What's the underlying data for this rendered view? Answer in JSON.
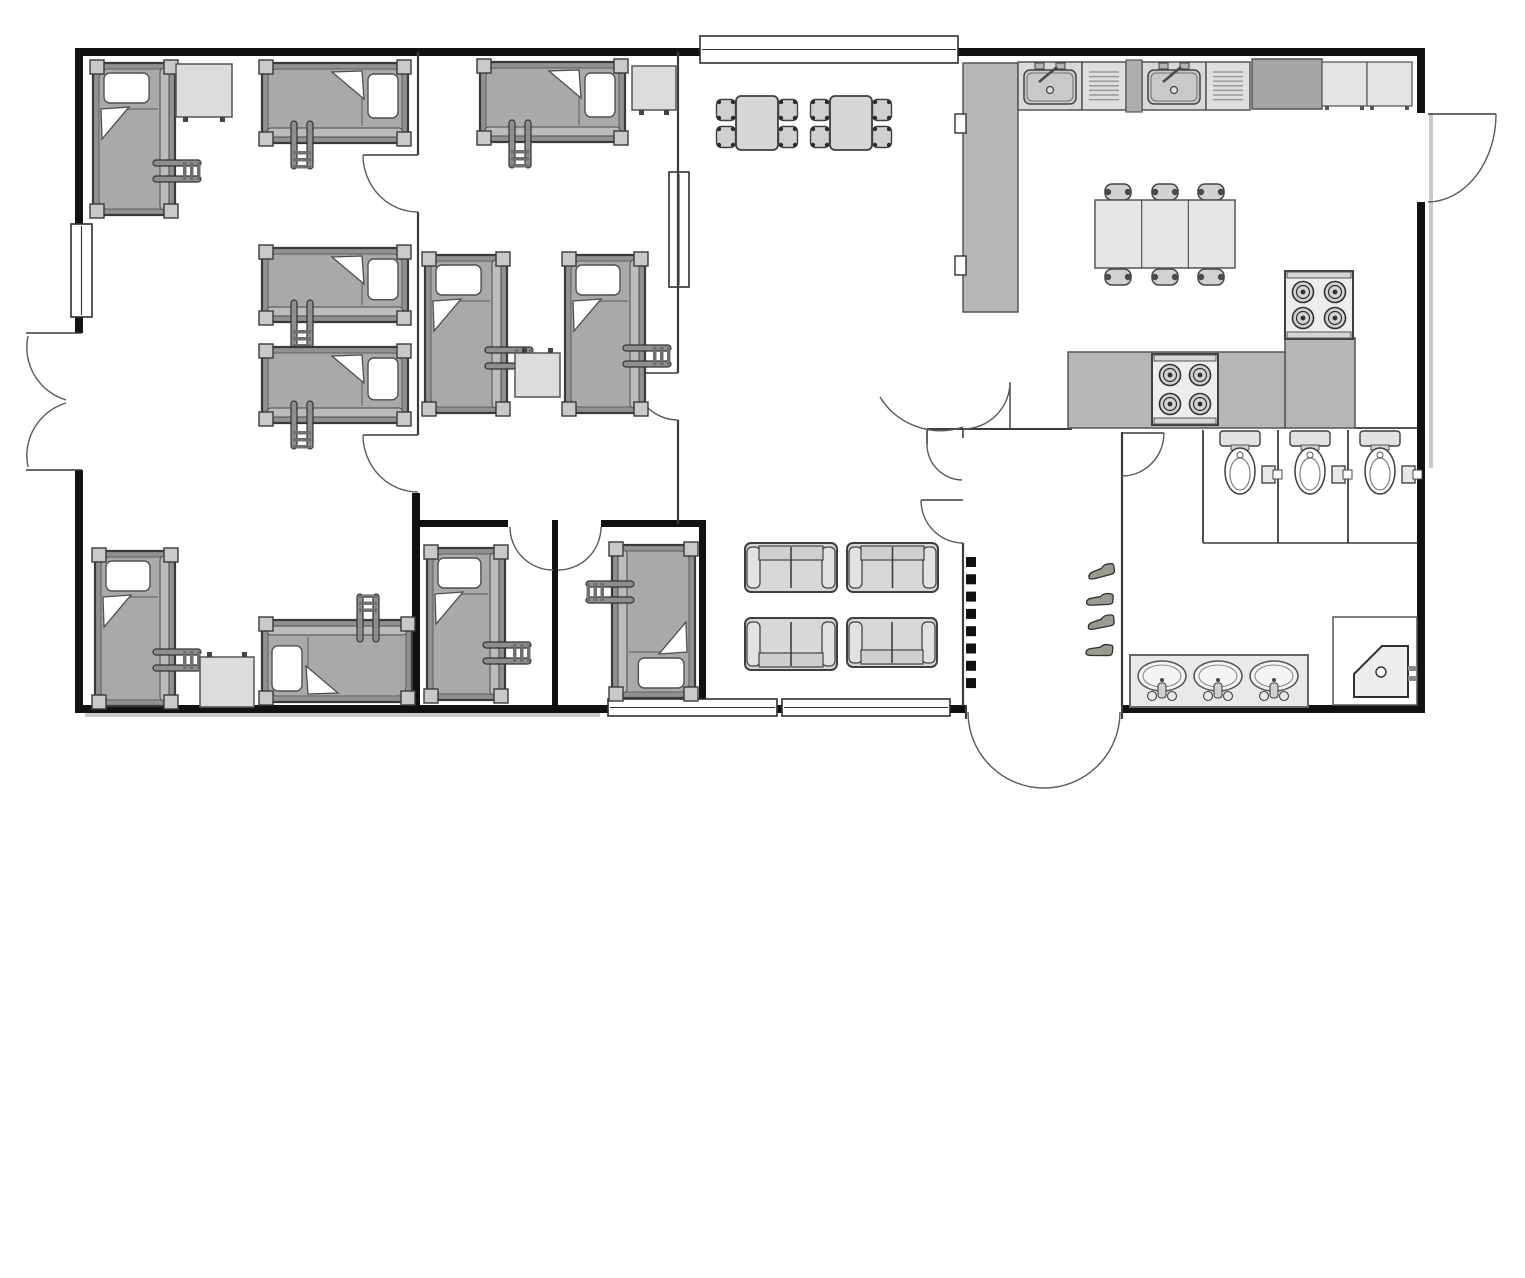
{
  "canvas": {
    "width": 1525,
    "height": 1278,
    "background": "#ffffff"
  },
  "palette": {
    "wall": "#111111",
    "thin_wall": "#3c3c3c",
    "door_arc": "#5a5a5a",
    "shadow": "#c9c9c9",
    "bed_frame": "#919191",
    "bed_mattress": "#a9a9a9",
    "bed_post": "#c9c9c9",
    "bed_rail": "#bcbcbc",
    "ladder": "#8e8e8e",
    "light_furniture": "#dcdcdc",
    "sofa": "#d8d8d8",
    "counter": "#b6b6b6",
    "counter_dark": "#a5a5a5",
    "appliance": "#ededed",
    "white": "#ffffff"
  },
  "plan": {
    "walls": [
      [
        75,
        48,
        1350,
        8
      ],
      [
        75,
        48,
        8,
        285
      ],
      [
        75,
        470,
        8,
        243
      ],
      [
        1417,
        48,
        8,
        65
      ],
      [
        1417,
        202,
        8,
        511
      ],
      [
        75,
        705,
        533,
        8
      ],
      [
        777,
        705,
        5,
        8
      ],
      [
        950,
        705,
        16,
        8
      ],
      [
        1122,
        705,
        303,
        8
      ],
      [
        412,
        493,
        8,
        219
      ],
      [
        420,
        520,
        88,
        7
      ],
      [
        552,
        520,
        6,
        192
      ],
      [
        601,
        520,
        104,
        7
      ],
      [
        699,
        520,
        7,
        192
      ]
    ],
    "shadows": [
      [
        85,
        713,
        515,
        4
      ],
      [
        1429,
        113,
        4,
        355
      ]
    ],
    "thin_walls": [
      [
        418,
        52,
        418,
        155,
        2.2
      ],
      [
        418,
        212,
        418,
        435,
        2.2
      ],
      [
        678,
        52,
        678,
        373,
        2.2
      ],
      [
        678,
        420,
        678,
        524,
        2.2
      ],
      [
        927,
        429,
        1072,
        429,
        2
      ],
      [
        927,
        429,
        927,
        444,
        1.6
      ],
      [
        963,
        429,
        963,
        438,
        1.6
      ],
      [
        1010,
        382,
        1010,
        429,
        1.4
      ],
      [
        633,
        373,
        678,
        373,
        1.4
      ],
      [
        363,
        155,
        418,
        155,
        1.4
      ],
      [
        363,
        435,
        418,
        435,
        1.4
      ],
      [
        921,
        500,
        963,
        500,
        1.4
      ],
      [
        1122,
        433,
        1164,
        433,
        1.4
      ],
      [
        1428,
        114,
        1496,
        114,
        1.4
      ],
      [
        963,
        543,
        963,
        706,
        2.2
      ],
      [
        1122,
        432,
        1122,
        706,
        2.2
      ],
      [
        1203,
        430,
        1203,
        543,
        1.8
      ],
      [
        1278,
        430,
        1278,
        543,
        1.8
      ],
      [
        1348,
        430,
        1348,
        543,
        1.8
      ],
      [
        1203,
        543,
        1418,
        543,
        1.6
      ],
      [
        1355,
        428,
        1418,
        428,
        1.8
      ],
      [
        966,
        705,
        966,
        719,
        2
      ],
      [
        1122,
        705,
        1122,
        719,
        2
      ],
      [
        26,
        333,
        82,
        333,
        1.6
      ],
      [
        26,
        470,
        82,
        470,
        1.6
      ]
    ],
    "door_arcs": [
      {
        "d": "M963,429 A47,47 0 0 0 1010,382"
      },
      {
        "d": "M880,397 A71,71 0 0 0 963,427"
      },
      {
        "d": "M927,444 A36,36 0 0 0 962,480"
      },
      {
        "d": "M921,500 A42,43 0 0 0 963,543"
      },
      {
        "d": "M1164,433 A42,43 0 0 1 1122,476"
      },
      {
        "d": "M633,373 A45,47 0 0 0 678,420"
      },
      {
        "d": "M363,155 A55,57 0 0 0 418,212"
      },
      {
        "d": "M363,435 A55,57 0 0 0 418,492"
      },
      {
        "d": "M510,527 A43,43 0 0 0 553,570"
      },
      {
        "d": "M601,527 A43,43 0 0 1 558,570"
      },
      {
        "d": "M968,712 A76,76 0 0 0 1044,788"
      },
      {
        "d": "M1120,712 A76,76 0 0 1 1044,788"
      },
      {
        "d": "M1496,114 A69,88 0 0 1 1428,202"
      },
      {
        "d": "M28,336 A55,55 0 0 0 66,400"
      },
      {
        "d": "M28,467 A55,55 0 0 1 66,403"
      }
    ],
    "windows": [
      {
        "x": 700,
        "y": 36,
        "w": 258,
        "h": 27,
        "o": "h"
      },
      {
        "x": 71,
        "y": 224,
        "w": 21,
        "h": 93,
        "o": "v"
      },
      {
        "x": 669,
        "y": 172,
        "w": 20,
        "h": 115,
        "o": "v"
      },
      {
        "x": 608,
        "y": 699,
        "w": 169,
        "h": 17,
        "o": "h"
      },
      {
        "x": 782,
        "y": 699,
        "w": 168,
        "h": 17,
        "o": "h"
      }
    ],
    "beds": [
      {
        "x": 93,
        "y": 63,
        "w": 82,
        "h": 152,
        "rot": 0,
        "lcy": 108
      },
      {
        "x": 262,
        "y": 63,
        "w": 146,
        "h": 80,
        "rot": 90,
        "lcy": 106
      },
      {
        "x": 262,
        "y": 248,
        "w": 146,
        "h": 74,
        "rot": 90,
        "lcy": 106
      },
      {
        "x": 262,
        "y": 347,
        "w": 146,
        "h": 76,
        "rot": 90,
        "lcy": 106
      },
      {
        "x": 480,
        "y": 62,
        "w": 145,
        "h": 80,
        "rot": 90,
        "lcy": 105
      },
      {
        "x": 425,
        "y": 255,
        "w": 82,
        "h": 158,
        "rot": 0,
        "lcy": 103
      },
      {
        "x": 565,
        "y": 255,
        "w": 80,
        "h": 158,
        "rot": 0,
        "lcy": 101
      },
      {
        "x": 95,
        "y": 551,
        "w": 80,
        "h": 155,
        "rot": 0,
        "lcy": 109
      },
      {
        "x": 262,
        "y": 620,
        "w": 150,
        "h": 82,
        "rot": 270,
        "lcy": 106
      },
      {
        "x": 427,
        "y": 548,
        "w": 78,
        "h": 152,
        "rot": 0,
        "lcy": 105
      },
      {
        "x": 612,
        "y": 545,
        "w": 83,
        "h": 153,
        "rot": 180,
        "lcy": 106
      }
    ],
    "desks": [
      {
        "x": 176,
        "y": 64,
        "w": 56,
        "h": 53,
        "feet": "S"
      },
      {
        "x": 632,
        "y": 66,
        "w": 44,
        "h": 44,
        "feet": "S"
      },
      {
        "x": 515,
        "y": 353,
        "w": 45,
        "h": 44,
        "feet": "N"
      },
      {
        "x": 200,
        "y": 657,
        "w": 54,
        "h": 50,
        "feet": "N"
      }
    ],
    "sofas": [
      {
        "x": 745,
        "y": 543,
        "w": 92,
        "h": 49,
        "back": "N"
      },
      {
        "x": 847,
        "y": 543,
        "w": 91,
        "h": 49,
        "back": "N"
      },
      {
        "x": 745,
        "y": 618,
        "w": 92,
        "h": 52,
        "back": "S"
      },
      {
        "x": 847,
        "y": 618,
        "w": 90,
        "h": 49,
        "back": "S"
      }
    ],
    "table_chair_sets": [
      {
        "x": 736,
        "y": 96,
        "w": 42,
        "h": 54
      },
      {
        "x": 830,
        "y": 96,
        "w": 42,
        "h": 54
      }
    ],
    "kitchen": {
      "island_counter": [
        963,
        63,
        55,
        249
      ],
      "pass_stubs": [
        [
          955,
          114
        ],
        [
          955,
          256
        ]
      ],
      "sink_units": [
        1018,
        1142
      ],
      "drainers": [
        1082,
        1206
      ],
      "divider": [
        1126,
        60,
        16,
        52
      ],
      "counter_dark": [
        1252,
        59,
        70,
        50
      ],
      "cabinets": [
        [
          1322,
          62,
          45,
          44
        ],
        [
          1367,
          62,
          45,
          44
        ]
      ],
      "counters": [
        [
          1285,
          338,
          70,
          90
        ],
        [
          1068,
          352,
          217,
          76
        ]
      ],
      "stoves": [
        {
          "x": 1285,
          "y": 271,
          "w": 68,
          "h": 68
        },
        {
          "x": 1152,
          "y": 354,
          "w": 66,
          "h": 71
        }
      ],
      "dining_table": {
        "x": 1095,
        "y": 200,
        "w": 140,
        "h": 68,
        "chair_xs": [
          1118,
          1165,
          1211
        ],
        "chair_n_y": 192,
        "chair_s_y": 277
      }
    },
    "bathroom": {
      "toilets": [
        1240,
        1310,
        1380
      ],
      "tp_holders": [
        1278,
        1348,
        1418
      ],
      "vanity": [
        1130,
        655,
        178,
        52
      ],
      "vanity_sinks": [
        1162,
        1218,
        1274
      ],
      "shower": {
        "box": [
          1333,
          617,
          84,
          88
        ],
        "tray": "1354,697 1354,674 1382,646 1408,646 1408,697",
        "drain": [
          1381,
          672
        ],
        "handle": [
          1408,
          666
        ]
      }
    },
    "vestibule": {
      "hooks": {
        "x": 966,
        "y0": 557,
        "step": 17.3,
        "count": 8,
        "size": 10
      },
      "shoes": [
        {
          "x": 1086,
          "y": 566,
          "rot": -8
        },
        {
          "x": 1086,
          "y": 591,
          "rot": 4
        },
        {
          "x": 1086,
          "y": 616,
          "rot": -5
        },
        {
          "x": 1086,
          "y": 641,
          "rot": 7
        }
      ]
    }
  }
}
